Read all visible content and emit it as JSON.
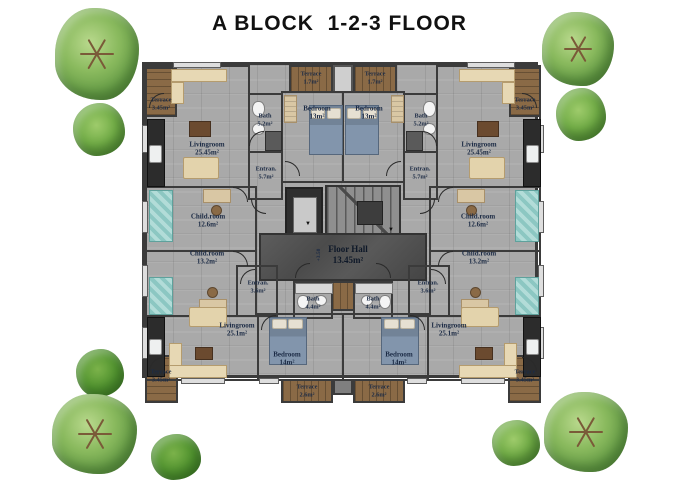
{
  "title": "A BLOCK  1-2-3 FLOOR",
  "hall": {
    "name": "Floor Hall",
    "area": "13.45m²",
    "level": "+3.50"
  },
  "apartments": {
    "top_left": {
      "livingroom": {
        "name": "Livingroom",
        "area": "25.45m²"
      },
      "bedroom": {
        "name": "Bedroom",
        "area": "13m²"
      },
      "bath": {
        "name": "Bath",
        "area": "5.2m²"
      },
      "entrance": {
        "name": "Entran.",
        "area": "5.7m²"
      },
      "childroom": {
        "name": "Child.room",
        "area": "12.6m²"
      },
      "terrace_side": {
        "name": "Terrace",
        "area": "3.45m²"
      },
      "terrace_top": {
        "name": "Terrace",
        "area": "1.7m²"
      }
    },
    "top_right": {
      "livingroom": {
        "name": "Livingroom",
        "area": "25.45m²"
      },
      "bedroom": {
        "name": "Bedroom",
        "area": "13m²"
      },
      "bath": {
        "name": "Bath",
        "area": "5.2m²"
      },
      "entrance": {
        "name": "Entran.",
        "area": "5.7m²"
      },
      "childroom": {
        "name": "Child.room",
        "area": "12.6m²"
      },
      "terrace_side": {
        "name": "Terrace",
        "area": "3.45m²"
      },
      "terrace_top": {
        "name": "Terrace",
        "area": "1.7m²"
      }
    },
    "bottom_left": {
      "livingroom": {
        "name": "Livingroom",
        "area": "25.1m²"
      },
      "bedroom": {
        "name": "Bedroom",
        "area": "14m²"
      },
      "bath": {
        "name": "Bath",
        "area": "4.4m²"
      },
      "entrance": {
        "name": "Entran.",
        "area": "3.6m²"
      },
      "childroom": {
        "name": "Child.room",
        "area": "13.2m²"
      },
      "terrace_side": {
        "name": "Terrace",
        "area": "3.45m²"
      },
      "terrace_bottom": {
        "name": "Terrace",
        "area": "2.6m²"
      }
    },
    "bottom_right": {
      "livingroom": {
        "name": "Livingroom",
        "area": "25.1m²"
      },
      "bedroom": {
        "name": "Bedroom",
        "area": "14m²"
      },
      "bath": {
        "name": "Bath",
        "area": "4.4m²"
      },
      "entrance": {
        "name": "Entran.",
        "area": "3.6m²"
      },
      "childroom": {
        "name": "Child.room",
        "area": "13.2m²"
      },
      "terrace_side": {
        "name": "Terrace",
        "area": "3.45m²"
      },
      "terrace_bottom": {
        "name": "Terrace",
        "area": "2.6m²"
      }
    }
  },
  "colors": {
    "wall": "#3b3b3b",
    "floor": "#a9a9a9",
    "hall_floor": "#525252",
    "terrace_wood": "#8a6a46",
    "label_text": "#1c2b45",
    "tree_green": "#84b85c",
    "bush_green": "#4f9032"
  }
}
